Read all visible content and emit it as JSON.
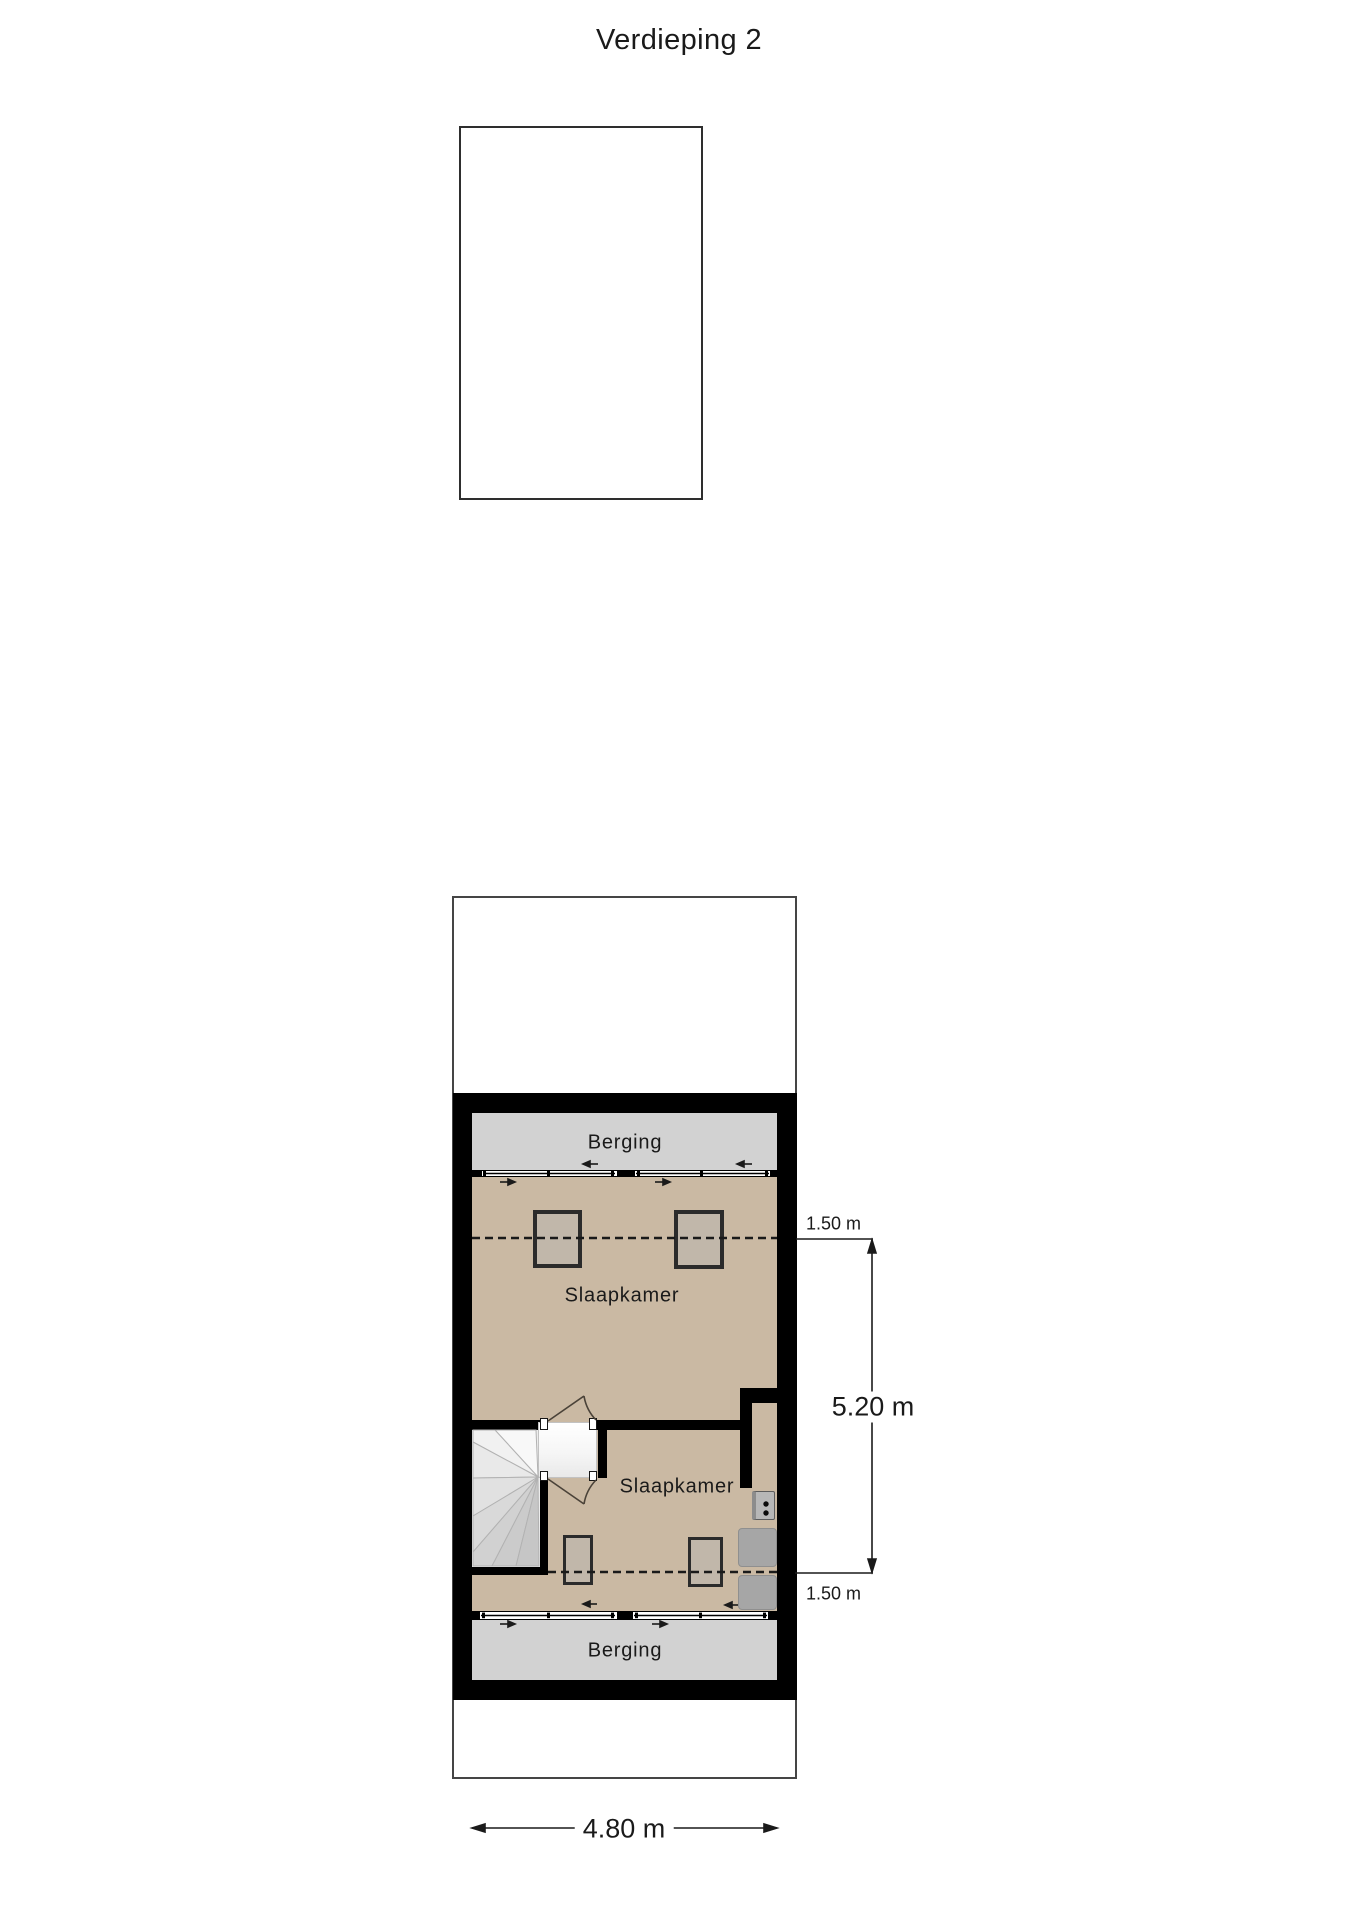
{
  "title": "Verdieping 2",
  "rooms": {
    "berging_top": "Berging",
    "slaapkamer_top": "Slaapkamer",
    "slaapkamer_bottom": "Slaapkamer",
    "berging_bottom": "Berging"
  },
  "dimensions": {
    "height_top": "1.50 m",
    "height_total": "5.20 m",
    "height_bottom": "1.50 m",
    "width_total": "4.80 m"
  },
  "colors": {
    "wall": "#000000",
    "floor": "#cab9a3",
    "storage_floor": "#d2d2d2",
    "furniture_fill": "#c1b7aa",
    "furniture_border": "#2b2b2b",
    "cabinet": "#a6a6a6",
    "line": "#1a1a1a",
    "text": "#1a1a1a",
    "window": "#ffffff",
    "page_bg": "#ffffff"
  }
}
